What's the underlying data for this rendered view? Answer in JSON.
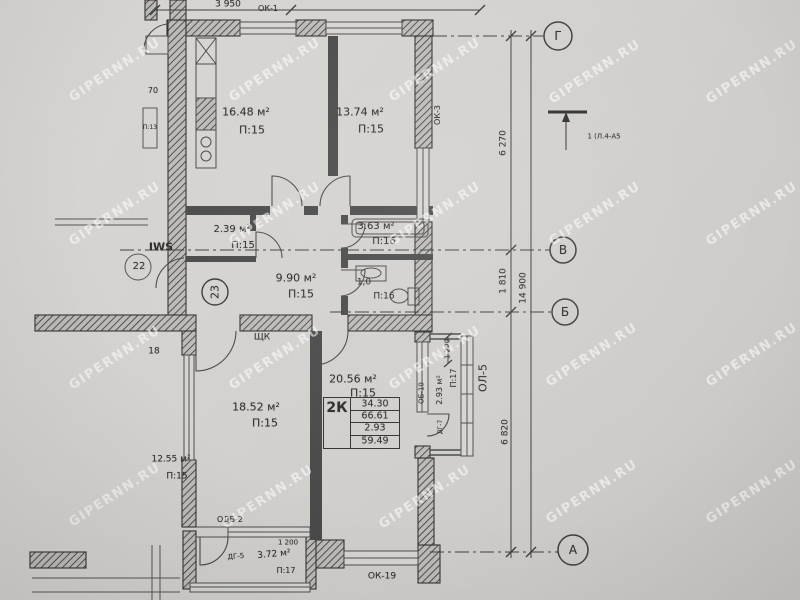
{
  "watermark": {
    "text": "GIPERNN.RU"
  },
  "plan": {
    "unit_number": "23",
    "stamp": {
      "type": "2К",
      "rows": [
        "34.30",
        "66.61",
        "2.93",
        "59.49"
      ]
    },
    "rooms": {
      "kitchen": {
        "area": "16.48 м²",
        "floor": "П:15"
      },
      "bedroom1": {
        "area": "13.74 м²",
        "floor": "П:15"
      },
      "closet": {
        "area": "2.39 м²",
        "floor": "П:15"
      },
      "bathroom": {
        "area": "3.63 м²",
        "floor": "П:16"
      },
      "hallway": {
        "area": "9.90 м²",
        "floor": "П:15"
      },
      "wc": {
        "area": "1,0",
        "floor": "П:16"
      },
      "bedroom2": {
        "area": "18.52 м²",
        "floor": "П:15"
      },
      "living": {
        "area": "20.56 м²",
        "floor": "П:15"
      },
      "loggia": {
        "area": "2.93 м²",
        "floor": "П:17",
        "width": "1 200"
      },
      "balcony": {
        "area": "3.72 м²",
        "floor": "П:17",
        "width": "1 200"
      }
    },
    "openings": {
      "ok1": "ОК-1",
      "ok3": "ОК-3",
      "ok19": "ОК-19",
      "ol5": "ОЛ-5",
      "ob10": "ОБ-10",
      "dg7": "ДГ-7",
      "dg5": "ДГ-5",
      "odb2": "ОДБ-2",
      "shk": "ЩК"
    },
    "dimensions": {
      "top": "3 950",
      "axis_g_v": "6 270",
      "axis_v_b": "1 810",
      "axis_b_a": "6 820",
      "axis_total": "14 900"
    },
    "axes": {
      "g": "Г",
      "v": "В",
      "b": "Б",
      "a": "А"
    },
    "section_mark": "1 (Л.4-А5",
    "neighbor": {
      "unit_number": "22",
      "iws": "IWS",
      "num70": "70",
      "p13": "П:13",
      "num18": "18",
      "room": {
        "area": "12.55 м²",
        "floor": "П:15"
      }
    }
  }
}
